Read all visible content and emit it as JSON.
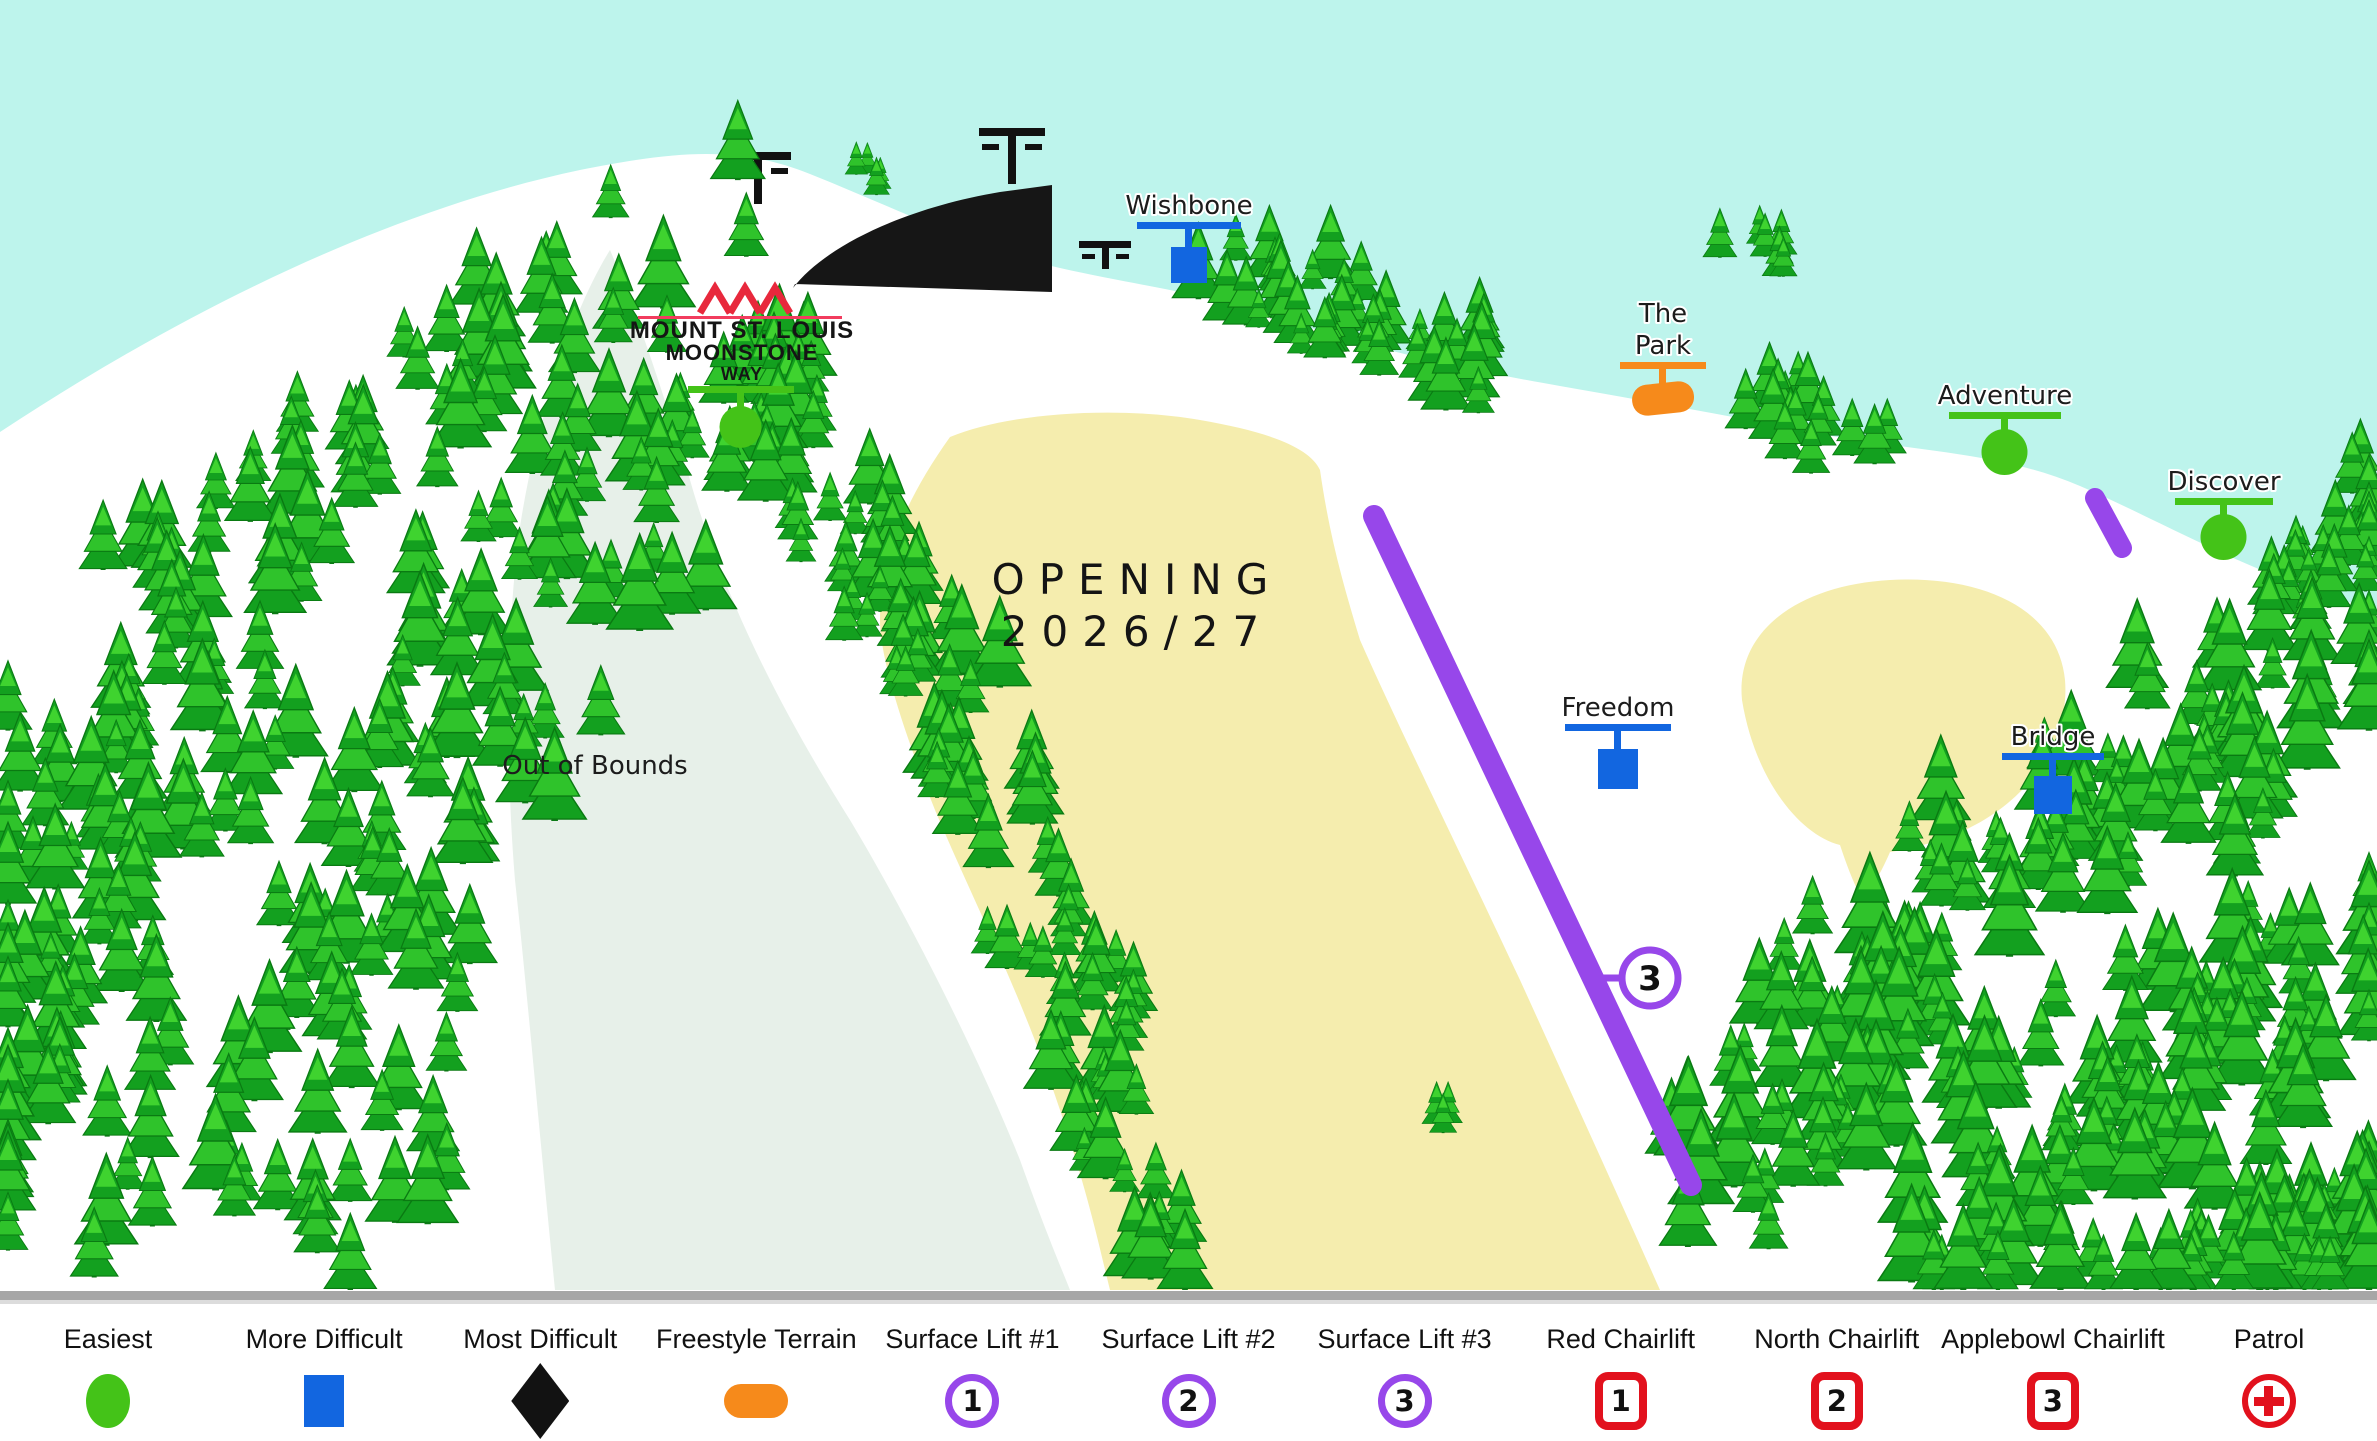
{
  "map": {
    "logo": {
      "line1": "MOUNT ST. LOUIS",
      "line2": "MOONSTONE",
      "line3": "WAY"
    },
    "opening": {
      "line1": "OPENING",
      "line2": "2026/27"
    },
    "out_of_bounds": "Out of Bounds",
    "runs": {
      "wishbone": "Wishbone",
      "the_park_line1": "The",
      "the_park_line2": "Park",
      "adventure": "Adventure",
      "discover": "Discover",
      "freedom": "Freedom",
      "bridge": "Bridge"
    },
    "surface_lift_3_badge": "3"
  },
  "legend": {
    "items": [
      {
        "label": "Easiest",
        "symbol": "green-circle"
      },
      {
        "label": "More Difficult",
        "symbol": "blue-square"
      },
      {
        "label": "Most Difficult",
        "symbol": "black-diamond"
      },
      {
        "label": "Freestyle Terrain",
        "symbol": "orange-pill"
      },
      {
        "label": "Surface Lift #1",
        "symbol": "purple-circle",
        "number": "1"
      },
      {
        "label": "Surface Lift #2",
        "symbol": "purple-circle",
        "number": "2"
      },
      {
        "label": "Surface Lift #3",
        "symbol": "purple-circle",
        "number": "3"
      },
      {
        "label": "Red Chairlift",
        "symbol": "red-square",
        "number": "1"
      },
      {
        "label": "North Chairlift",
        "symbol": "red-square",
        "number": "2"
      },
      {
        "label": "Applebowl Chairlift",
        "symbol": "red-square",
        "number": "3"
      },
      {
        "label": "Patrol",
        "symbol": "red-cross"
      }
    ]
  },
  "colors": {
    "sky": "#bdf4ec",
    "snow": "#ffffff",
    "out_of_bounds_grey": "#e7f0e9",
    "glade_yellow": "#f5edae",
    "easiest_green": "#44c318",
    "more_difficult_blue": "#1266e0",
    "most_difficult_black": "#121212",
    "freestyle_orange": "#f68a1b",
    "surface_lift_purple": "#9747ea",
    "chairlift_red": "#e2111d",
    "tree_green": "#2fc32b",
    "logo_red": "#e8283c",
    "road_grey": "#a6a6a6"
  }
}
